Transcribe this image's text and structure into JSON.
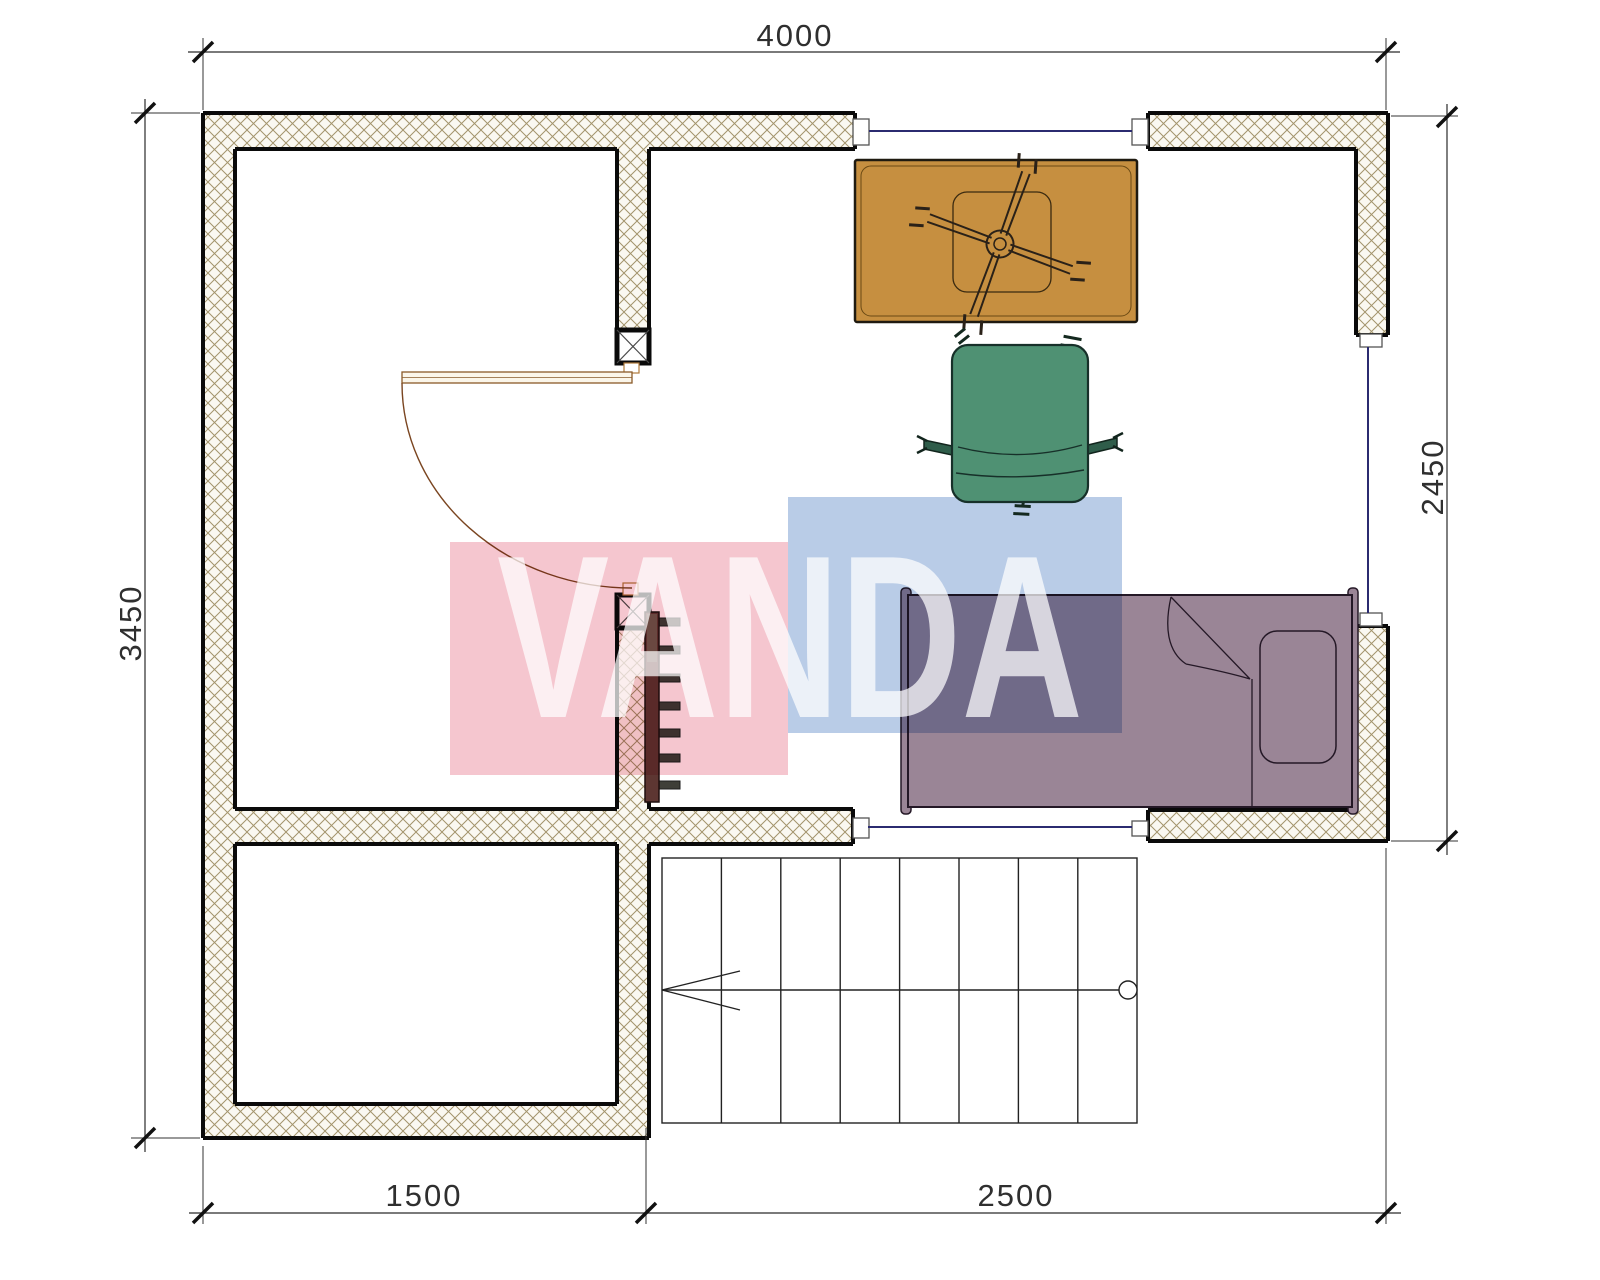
{
  "plan": {
    "dimensions": {
      "top": "4000",
      "left": "3450",
      "right": "2450",
      "bottom_left": "1500",
      "bottom_right": "2500"
    },
    "watermark": {
      "text": "VANDA",
      "pink_color": "#f5c6cf",
      "blue_color": "#b9cce7"
    },
    "colors": {
      "desk": "#c68f40",
      "armchair": "#4f9173",
      "armchair_dark": "#2f5d4a",
      "bed": "#9a8596",
      "radiator": "#5d3632",
      "wall_hatch": "#a3946c",
      "window_line": "#2b2b70"
    },
    "stairs": {
      "treads": 8,
      "direction": "arrow-left"
    },
    "furniture": [
      "desk",
      "office-chair-base",
      "armchair",
      "single-bed",
      "radiator",
      "stairs"
    ]
  }
}
